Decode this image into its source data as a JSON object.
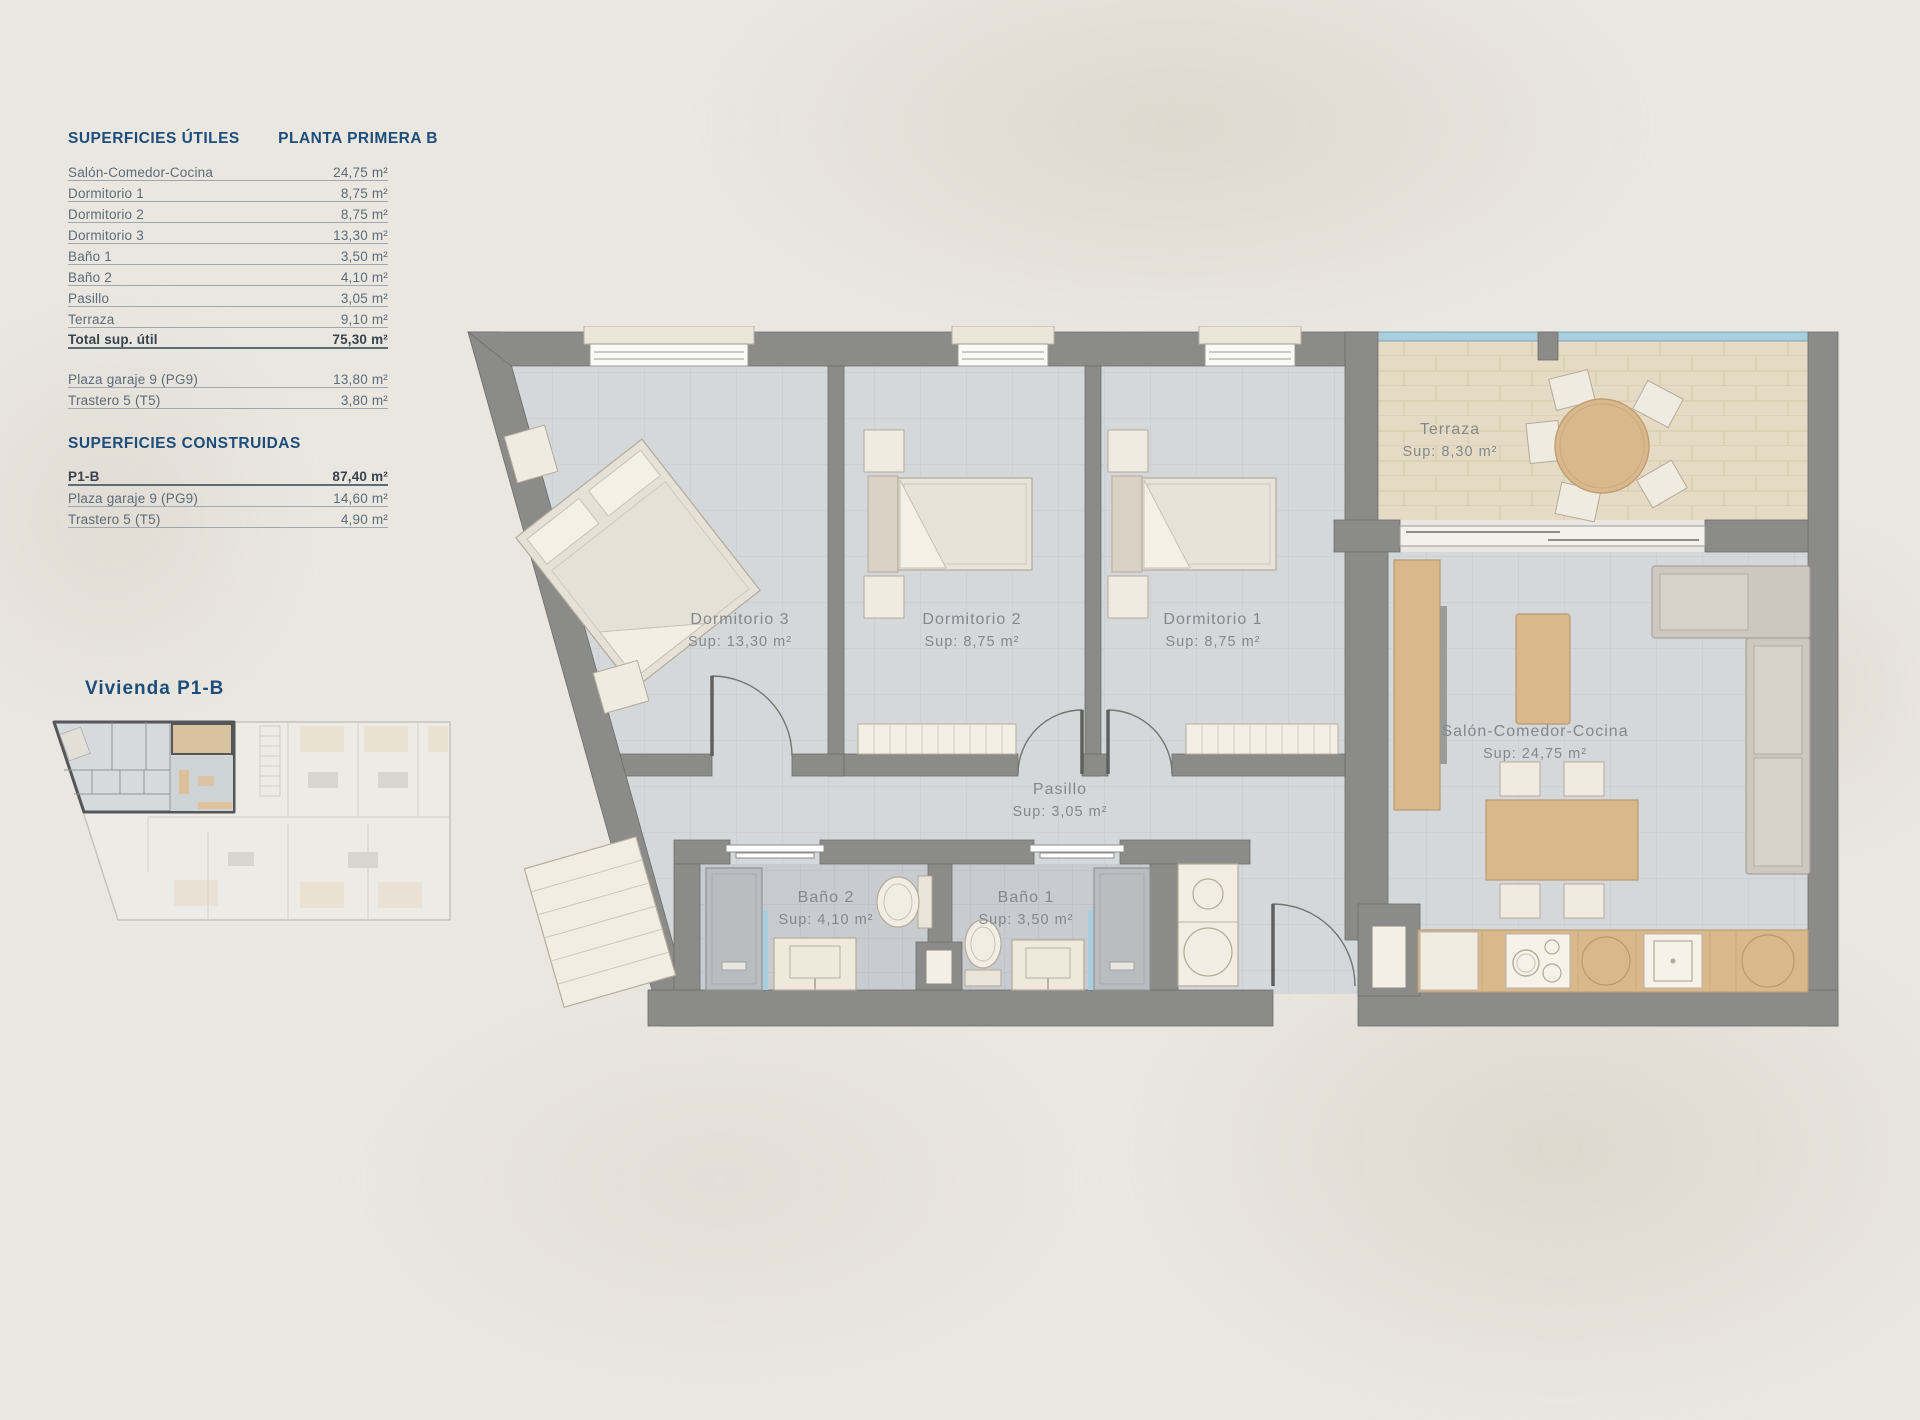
{
  "colors": {
    "background": "#eae7e1",
    "heading_blue": "#1d4d7b",
    "row_text": "#5d6b78",
    "wall_gray": "#8b8b89",
    "floor_tile": "#d5d8da",
    "bath_tile": "#c8ccd0",
    "terrace_tile": "#e5dbc4",
    "wood": "#d9b88d",
    "glass_blue": "#a9cfdf",
    "furniture_cream": "#f0ebe0"
  },
  "left_panel": {
    "utiles": {
      "title": "SUPERFICIES ÚTILES",
      "subtitle": "PLANTA PRIMERA B",
      "rows": [
        {
          "label": "Salón-Comedor-Cocina",
          "value": "24,75 m²"
        },
        {
          "label": "Dormitorio 1",
          "value": "8,75 m²"
        },
        {
          "label": "Dormitorio 2",
          "value": "8,75 m²"
        },
        {
          "label": "Dormitorio 3",
          "value": "13,30 m²"
        },
        {
          "label": "Baño 1",
          "value": "3,50 m²"
        },
        {
          "label": "Baño 2",
          "value": "4,10 m²"
        },
        {
          "label": "Pasillo",
          "value": "3,05 m²"
        },
        {
          "label": "Terraza",
          "value": "9,10 m²"
        },
        {
          "label": "Total sup. útil",
          "value": "75,30 m²",
          "bold": true
        }
      ],
      "annex_rows": [
        {
          "label": "Plaza garaje 9 (PG9)",
          "value": "13,80 m²"
        },
        {
          "label": "Trastero 5 (T5)",
          "value": "3,80 m²"
        }
      ]
    },
    "construidas": {
      "title": "SUPERFICIES CONSTRUIDAS",
      "rows": [
        {
          "label": "P1-B",
          "value": "87,40 m²",
          "bold": true
        },
        {
          "label": "Plaza garaje 9 (PG9)",
          "value": "14,60 m²"
        },
        {
          "label": "Trastero 5 (T5)",
          "value": "4,90 m²"
        }
      ]
    }
  },
  "mini_plan": {
    "title": "Vivienda P1-B"
  },
  "floor_plan": {
    "rooms": {
      "terraza": {
        "name": "Terraza",
        "sup": "Sup: 8,30 m²"
      },
      "dormitorio3": {
        "name": "Dormitorio 3",
        "sup": "Sup: 13,30 m²"
      },
      "dormitorio2": {
        "name": "Dormitorio 2",
        "sup": "Sup: 8,75 m²"
      },
      "dormitorio1": {
        "name": "Dormitorio 1",
        "sup": "Sup: 8,75 m²"
      },
      "pasillo": {
        "name": "Pasillo",
        "sup": "Sup: 3,05 m²"
      },
      "bano2": {
        "name": "Baño 2",
        "sup": "Sup: 4,10 m²"
      },
      "bano1": {
        "name": "Baño 1",
        "sup": "Sup: 3,50 m²"
      },
      "salon": {
        "name": "Salón-Comedor-Cocina",
        "sup": "Sup: 24,75 m²"
      }
    }
  }
}
